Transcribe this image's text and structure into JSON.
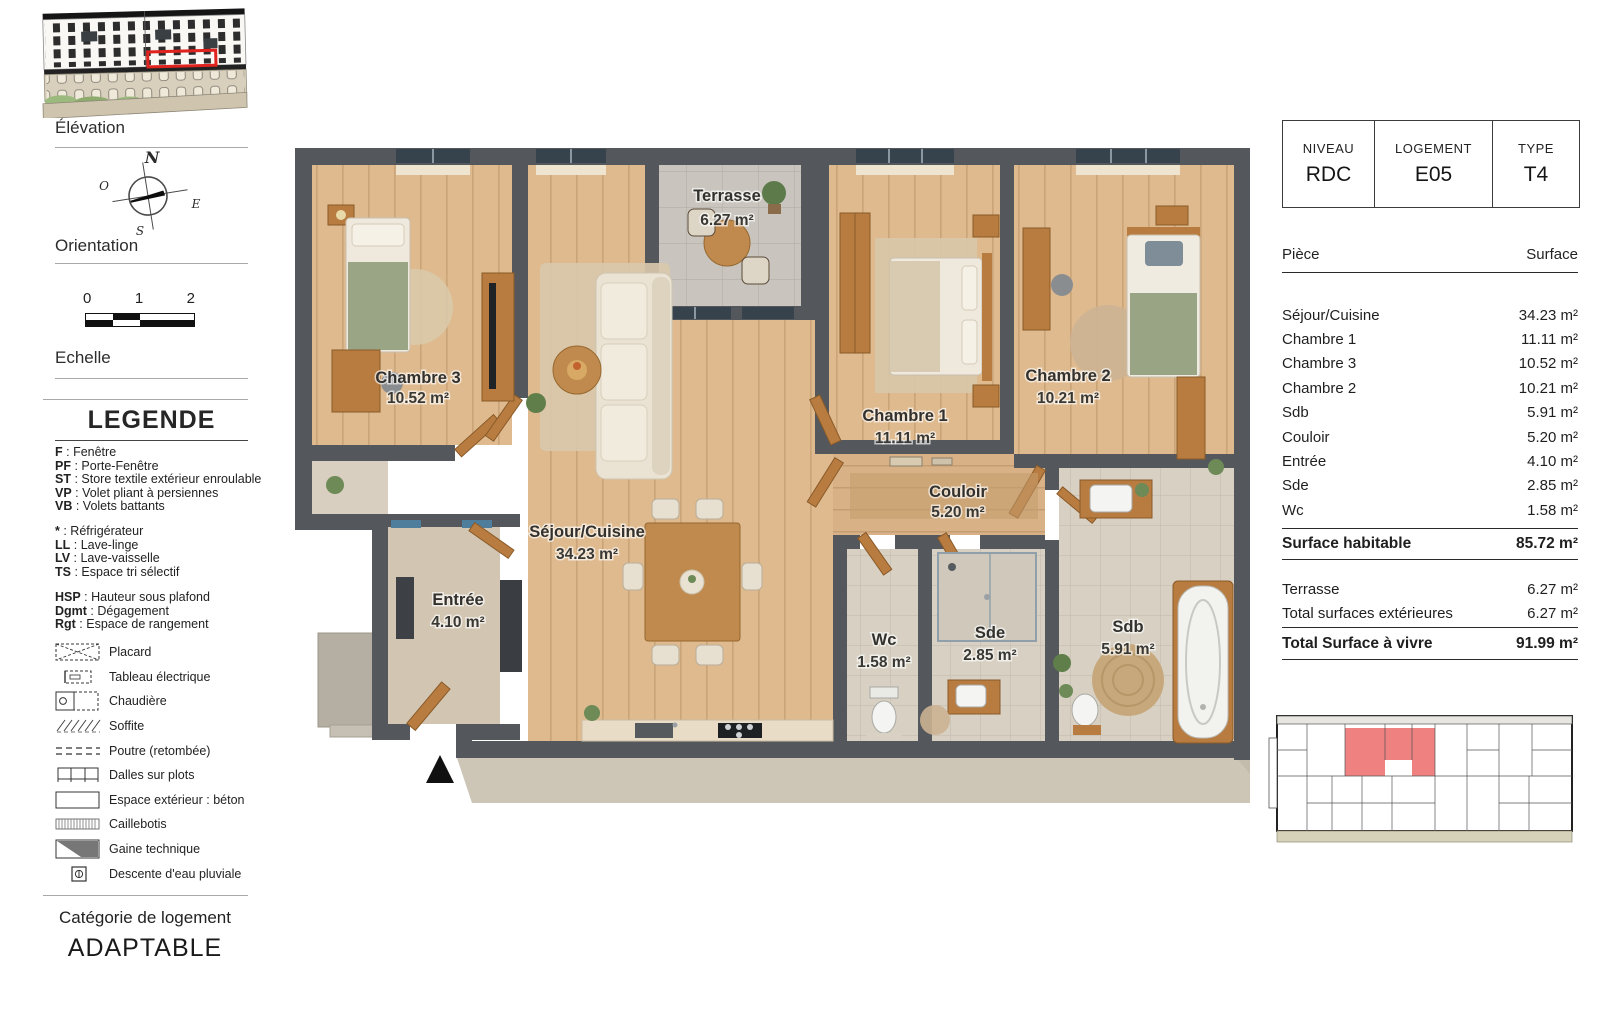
{
  "sidebar": {
    "elevation_label": "Élévation",
    "orientation_label": "Orientation",
    "compass": {
      "n": "N",
      "s": "S",
      "e": "E",
      "o": "O"
    },
    "scale": {
      "t0": "0",
      "t1": "1",
      "t2": "2",
      "label": "Echelle"
    },
    "legend": {
      "title": "LEGENDE",
      "separator": " : ",
      "abbr_groups": [
        [
          {
            "k": "F",
            "v": "Fenêtre"
          },
          {
            "k": "PF",
            "v": "Porte-Fenêtre"
          },
          {
            "k": "ST",
            "v": "Store textile extérieur enroulable"
          },
          {
            "k": "VP",
            "v": "Volet pliant à persiennes"
          },
          {
            "k": "VB",
            "v": "Volets battants"
          }
        ],
        [
          {
            "k": "*",
            "v": "Réfrigérateur"
          },
          {
            "k": "LL",
            "v": "Lave-linge"
          },
          {
            "k": "LV",
            "v": "Lave-vaisselle"
          },
          {
            "k": "TS",
            "v": "Espace tri sélectif"
          }
        ],
        [
          {
            "k": "HSP",
            "v": "Hauteur sous plafond"
          },
          {
            "k": "Dgmt",
            "v": "Dégagement"
          },
          {
            "k": "Rgt",
            "v": "Espace de rangement"
          }
        ]
      ],
      "symbols": [
        {
          "icon": "placard-icon",
          "label": "Placard"
        },
        {
          "icon": "tableau-electrique-icon",
          "label": "Tableau électrique"
        },
        {
          "icon": "chaudiere-icon",
          "label": "Chaudière"
        },
        {
          "icon": "soffite-icon",
          "label": "Soffite"
        },
        {
          "icon": "poutre-icon",
          "label": "Poutre (retombée)"
        },
        {
          "icon": "dalles-icon",
          "label": "Dalles sur plots"
        },
        {
          "icon": "espace-exterieur-icon",
          "label": "Espace extérieur : béton"
        },
        {
          "icon": "caillebotis-icon",
          "label": "Caillebotis"
        },
        {
          "icon": "gaine-technique-icon",
          "label": "Gaine technique"
        },
        {
          "icon": "descente-eau-icon",
          "label": "Descente d'eau pluviale"
        }
      ]
    },
    "category": {
      "label": "Catégorie de logement",
      "value": "ADAPTABLE"
    }
  },
  "plan": {
    "rooms": [
      {
        "name": "Chambre 3",
        "area": "10.52 m²"
      },
      {
        "name": "Terrasse",
        "area": "6.27 m²"
      },
      {
        "name": "Séjour/Cuisine",
        "area": "34.23 m²"
      },
      {
        "name": "Chambre 1",
        "area": "11.11 m²"
      },
      {
        "name": "Chambre 2",
        "area": "10.21 m²"
      },
      {
        "name": "Entrée",
        "area": "4.10 m²"
      },
      {
        "name": "Couloir",
        "area": "5.20 m²"
      },
      {
        "name": "Wc",
        "area": "1.58 m²"
      },
      {
        "name": "Sde",
        "area": "2.85 m²"
      },
      {
        "name": "Sdb",
        "area": "5.91 m²"
      }
    ]
  },
  "info": {
    "unit": {
      "level_label": "NIVEAU",
      "level": "RDC",
      "lot_label": "LOGEMENT",
      "lot": "E05",
      "type_label": "TYPE",
      "type": "T4"
    },
    "table": {
      "col_piece": "Pièce",
      "col_surface": "Surface",
      "rows": [
        {
          "piece": "Séjour/Cuisine",
          "surface": "34.23 m²"
        },
        {
          "piece": "Chambre 1",
          "surface": "11.11 m²"
        },
        {
          "piece": "Chambre 3",
          "surface": "10.52 m²"
        },
        {
          "piece": "Chambre 2",
          "surface": "10.21 m²"
        },
        {
          "piece": "Sdb",
          "surface": "5.91 m²"
        },
        {
          "piece": "Couloir",
          "surface": "5.20 m²"
        },
        {
          "piece": "Entrée",
          "surface": "4.10 m²"
        },
        {
          "piece": "Sde",
          "surface": "2.85 m²"
        },
        {
          "piece": "Wc",
          "surface": "1.58 m²"
        }
      ],
      "habitable": {
        "label": "Surface habitable",
        "value": "85.72 m²"
      },
      "ext_rows": [
        {
          "piece": "Terrasse",
          "surface": "6.27 m²"
        },
        {
          "piece": "Total surfaces extérieures",
          "surface": "6.27 m²"
        }
      ],
      "total": {
        "label": "Total Surface à vivre",
        "value": "91.99 m²"
      }
    }
  },
  "colors": {
    "highlight_red": "#e0231e",
    "keyplan_red": "#ef8181",
    "wall_gray": "#54585c",
    "wood_floor": "#debb90",
    "furniture_wood": "#b87c40"
  }
}
